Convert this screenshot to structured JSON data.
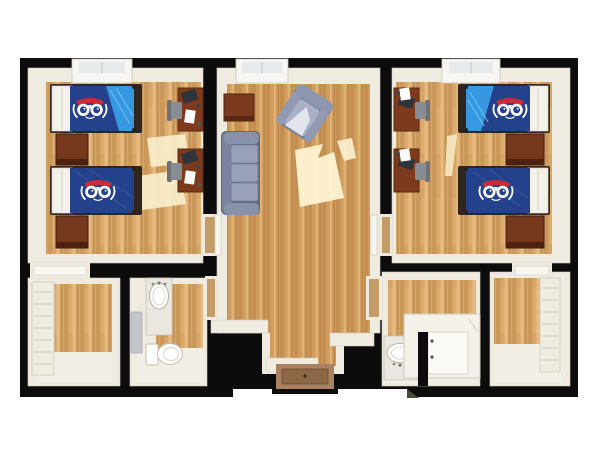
{
  "scene": {
    "type": "3d-floor-plan",
    "description": "Top-down 3D rendering of a two-bedroom residence-hall suite with shared living room, two bathrooms and two closets",
    "rooms": [
      {
        "id": "bedroom-left",
        "label": "Bedroom (left)",
        "furniture": [
          "twin bed with owl bedspread and folded blue corner",
          "twin bed with owl bedspread",
          "dresser",
          "dresser",
          "desk with monitor, papers and chair",
          "desk with monitor, papers and chair",
          "window"
        ]
      },
      {
        "id": "living-room",
        "label": "Living room",
        "furniture": [
          "three-seat sofa",
          "armchair (angled)",
          "side table",
          "window",
          "entry door"
        ]
      },
      {
        "id": "bedroom-right",
        "label": "Bedroom (right)",
        "furniture": [
          "twin bed with owl bedspread and folded blue corner",
          "twin bed with owl bedspread",
          "dresser",
          "dresser",
          "desk with monitor, papers and chair",
          "desk with monitor, papers and chair",
          "window"
        ]
      },
      {
        "id": "closet-left",
        "label": "Closet (left)",
        "furniture": [
          "shelving unit"
        ]
      },
      {
        "id": "bathroom-left",
        "label": "Bathroom (left)",
        "furniture": [
          "vanity sink",
          "mirror",
          "toilet"
        ]
      },
      {
        "id": "bathroom-right",
        "label": "Bathroom (right)",
        "furniture": [
          "vanity sink",
          "shower stall"
        ]
      },
      {
        "id": "closet-right",
        "label": "Closet (right)",
        "furniture": [
          "shelving unit"
        ]
      }
    ],
    "logo": "owl emblem on bedspreads"
  },
  "palette": {
    "background": "#ffffff",
    "walls": "#0c0c0c",
    "wall_trim": "#f0ebe0",
    "wall_trim_shadow": "#d8d1c1",
    "wood_base": "#d6a669",
    "wood_stripe_dark": "#c08a4a",
    "wood_stripe_light": "#ecc186",
    "wood_common_base": "#cf9c5e",
    "sunlight": "#f9eecb",
    "bedding_navy": "#24418c",
    "bedding_light_blue": "#3598e0",
    "bedding_fold_streak": "#7cc6f2",
    "owl_red": "#cc2b35",
    "owl_white": "#ffffff",
    "bed_frame_dark": "#31261d",
    "headboard_white": "#f3f1ea",
    "dresser_wood": "#76381c",
    "dresser_wood_dark": "#4c2110",
    "desk_wood": "#7d3a1c",
    "monitor_dark": "#2f343b",
    "paper_white": "#fafaf8",
    "chair_gray": "#888c93",
    "sofa_base": "#8791ac",
    "sofa_cushion": "#98a0ba",
    "sofa_shadow": "#626a84",
    "side_table_wood": "#7b3a1d",
    "porcelain": "#fdfdfb",
    "vanity_speckle": "#e9e7e0",
    "mirror_gray": "#c2c6c9",
    "threshold_tan": "#c49c67",
    "entry_floor_brown": "#ab8261",
    "light_floor": "#f2efe6",
    "window_pane": "#e6eaec"
  }
}
